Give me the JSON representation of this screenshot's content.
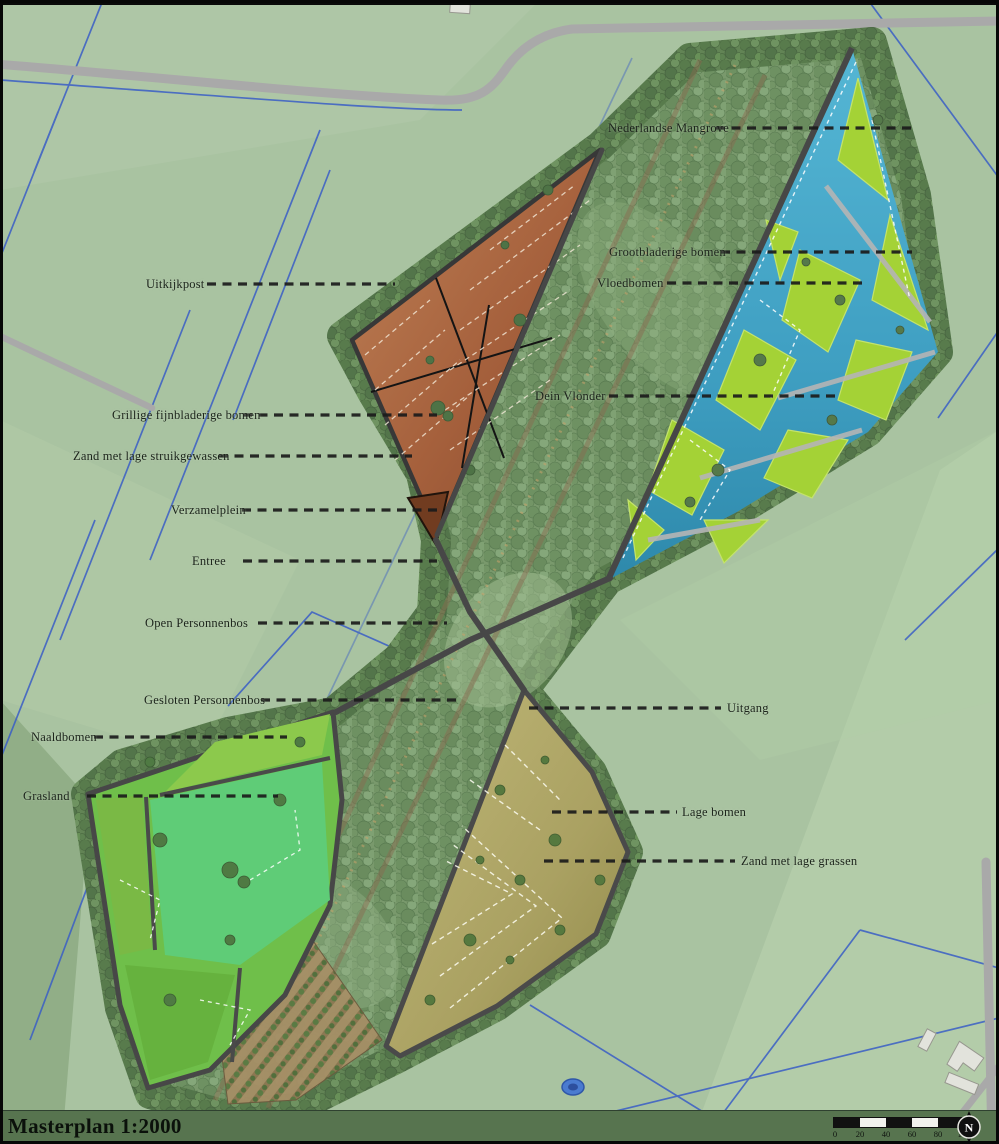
{
  "title": "Masterplan 1:2000",
  "north_label": "N",
  "scale_bar": {
    "ticks": [
      "0",
      "20",
      "40",
      "60",
      "80",
      "100"
    ]
  },
  "labels": [
    {
      "text": "Uitkijkpost"
    },
    {
      "text": "Grillige fijnbladerige bomen"
    },
    {
      "text": "Zand met lage struikgewassen"
    },
    {
      "text": "Verzamelplein"
    },
    {
      "text": "Entree"
    },
    {
      "text": "Open Personnenbos"
    },
    {
      "text": "Gesloten Personnenbos"
    },
    {
      "text": "Naaldbomen"
    },
    {
      "text": "Grasland"
    },
    {
      "text": "Nederlandse Mangrove"
    },
    {
      "text": "Grootbladerige bomen"
    },
    {
      "text": "Vloedbomen"
    },
    {
      "text": "Dein Vlonder"
    },
    {
      "text": "Uitgang"
    },
    {
      "text": "Lage bomen"
    },
    {
      "text": "Zand met lage grassen"
    }
  ],
  "colors": {
    "map_background": "#a9c3a1",
    "forest_canopy": "#6f9363",
    "zone_lookout_orange": "#a5603c",
    "mangrove_water_blue": "#3f9fc2",
    "mangrove_island_green": "#a4d236",
    "grassland_green": "#5fcc77",
    "sand_olive": "#b0a867",
    "ditch_blue": "#3a5ec6",
    "road_gray": "#a9a9a9",
    "footer_green": "#57744f",
    "leader_line": "#1b1b1b"
  }
}
